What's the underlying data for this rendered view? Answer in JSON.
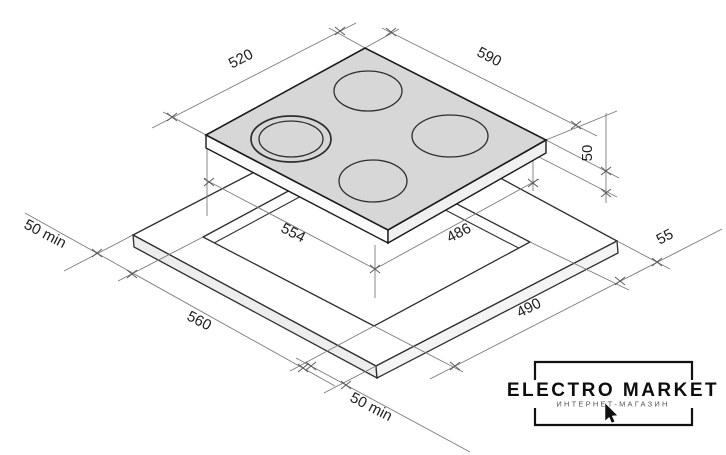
{
  "diagram": {
    "type": "hob-installation-drawing",
    "dims": {
      "hob_depth": "520",
      "hob_width": "590",
      "hob_height": "50",
      "body_width": "554",
      "body_depth": "486",
      "clearance_right": "55",
      "clearance_side": "50 min",
      "cutout_width": "560",
      "cutout_depth": "490",
      "clearance_front": "50 min"
    },
    "colors": {
      "hob_surface": "#d7d7d7",
      "outline": "#1a1a1a",
      "dim_line": "#7b7b7b"
    }
  },
  "logo": {
    "title": "ELECTRO MARKET",
    "subtitle": "ИНТЕРНЕТ-МАГАЗИН"
  }
}
